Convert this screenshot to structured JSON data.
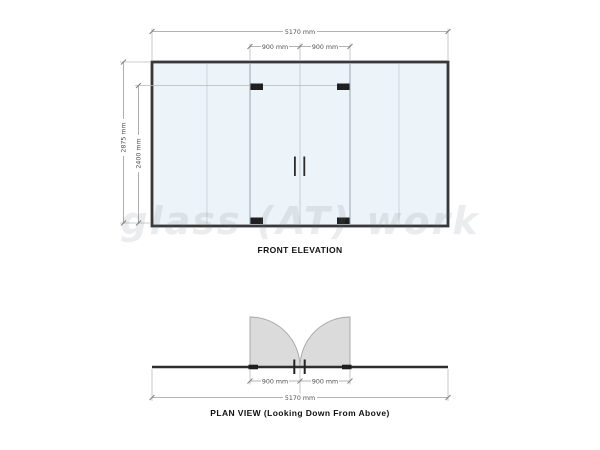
{
  "front_elevation": {
    "label": "FRONT ELEVATION",
    "dimensions": {
      "overall_width": "5170 mm",
      "left_door_width": "900 mm",
      "right_door_width": "900 mm",
      "overall_height": "2875 mm",
      "door_height": "2400 mm"
    }
  },
  "plan_view": {
    "label": "PLAN VIEW (Looking Down From Above)",
    "dimensions": {
      "left_door_width": "900 mm",
      "right_door_width": "900 mm",
      "overall_width": "5170 mm"
    }
  },
  "watermark": {
    "text": "glass (AT) work"
  },
  "colors": {
    "glass_fill": "#ecf4f9",
    "frame": "#383838",
    "door_swing_fill": "#dbdbdb",
    "fitting_black": "#1f1f1f",
    "dimension_line": "#9a9a9a"
  }
}
